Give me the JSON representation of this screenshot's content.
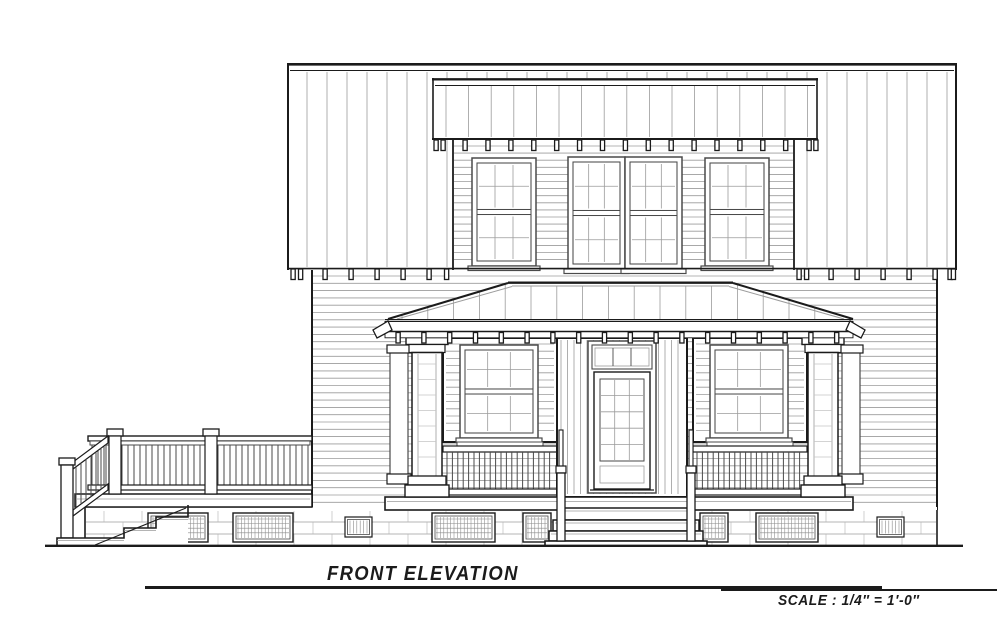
{
  "document": {
    "kind": "architectural elevation drawing",
    "title": "FRONT ELEVATION",
    "scale_label": "SCALE : 1/4″ = 1′-0″",
    "colors": {
      "paper": "#ffffff",
      "ink": "#1b1b1b",
      "medium_line": "#4a4a4a",
      "light_line": "#9b9b9b",
      "faint_line": "#c4c4c4"
    }
  },
  "elevation": {
    "stories": 2,
    "main_roof": {
      "finish": "standing-seam panels",
      "eave": "exposed rafter tails"
    },
    "dormer": {
      "siding": "horizontal lap",
      "windows": [
        {
          "position": "left",
          "type": "double-hung",
          "lites": "6 over 6"
        },
        {
          "position": "center",
          "type": "paired double-hung",
          "lites": "6 over 6 each"
        },
        {
          "position": "right",
          "type": "double-hung",
          "lites": "6 over 6"
        }
      ]
    },
    "porch": {
      "roof": "hipped, standing-seam, exposed rafter tails",
      "columns": "4 square craftsman columns with caps and plinths",
      "railings": "square-baluster panels under flanking windows"
    },
    "entry": {
      "door": {
        "type": "glazed door",
        "lites": "15 (3 x 5)"
      },
      "transom": {
        "lites": 3
      },
      "steps": {
        "treads": 3,
        "handrails": 2
      }
    },
    "first_floor_windows": [
      {
        "position": "left of door",
        "type": "double-hung",
        "lites": "6 over 6"
      },
      {
        "position": "right of door",
        "type": "double-hung",
        "lites": "6 over 6"
      }
    ],
    "deck": {
      "position": "left side",
      "railing": "square balusters with capped newel posts",
      "stairs": {
        "direction": "descending left",
        "risers": 4
      }
    },
    "foundation": {
      "material": "masonry block",
      "lattice_vents": 6,
      "slot_vents": 2
    },
    "ground_line": true
  }
}
